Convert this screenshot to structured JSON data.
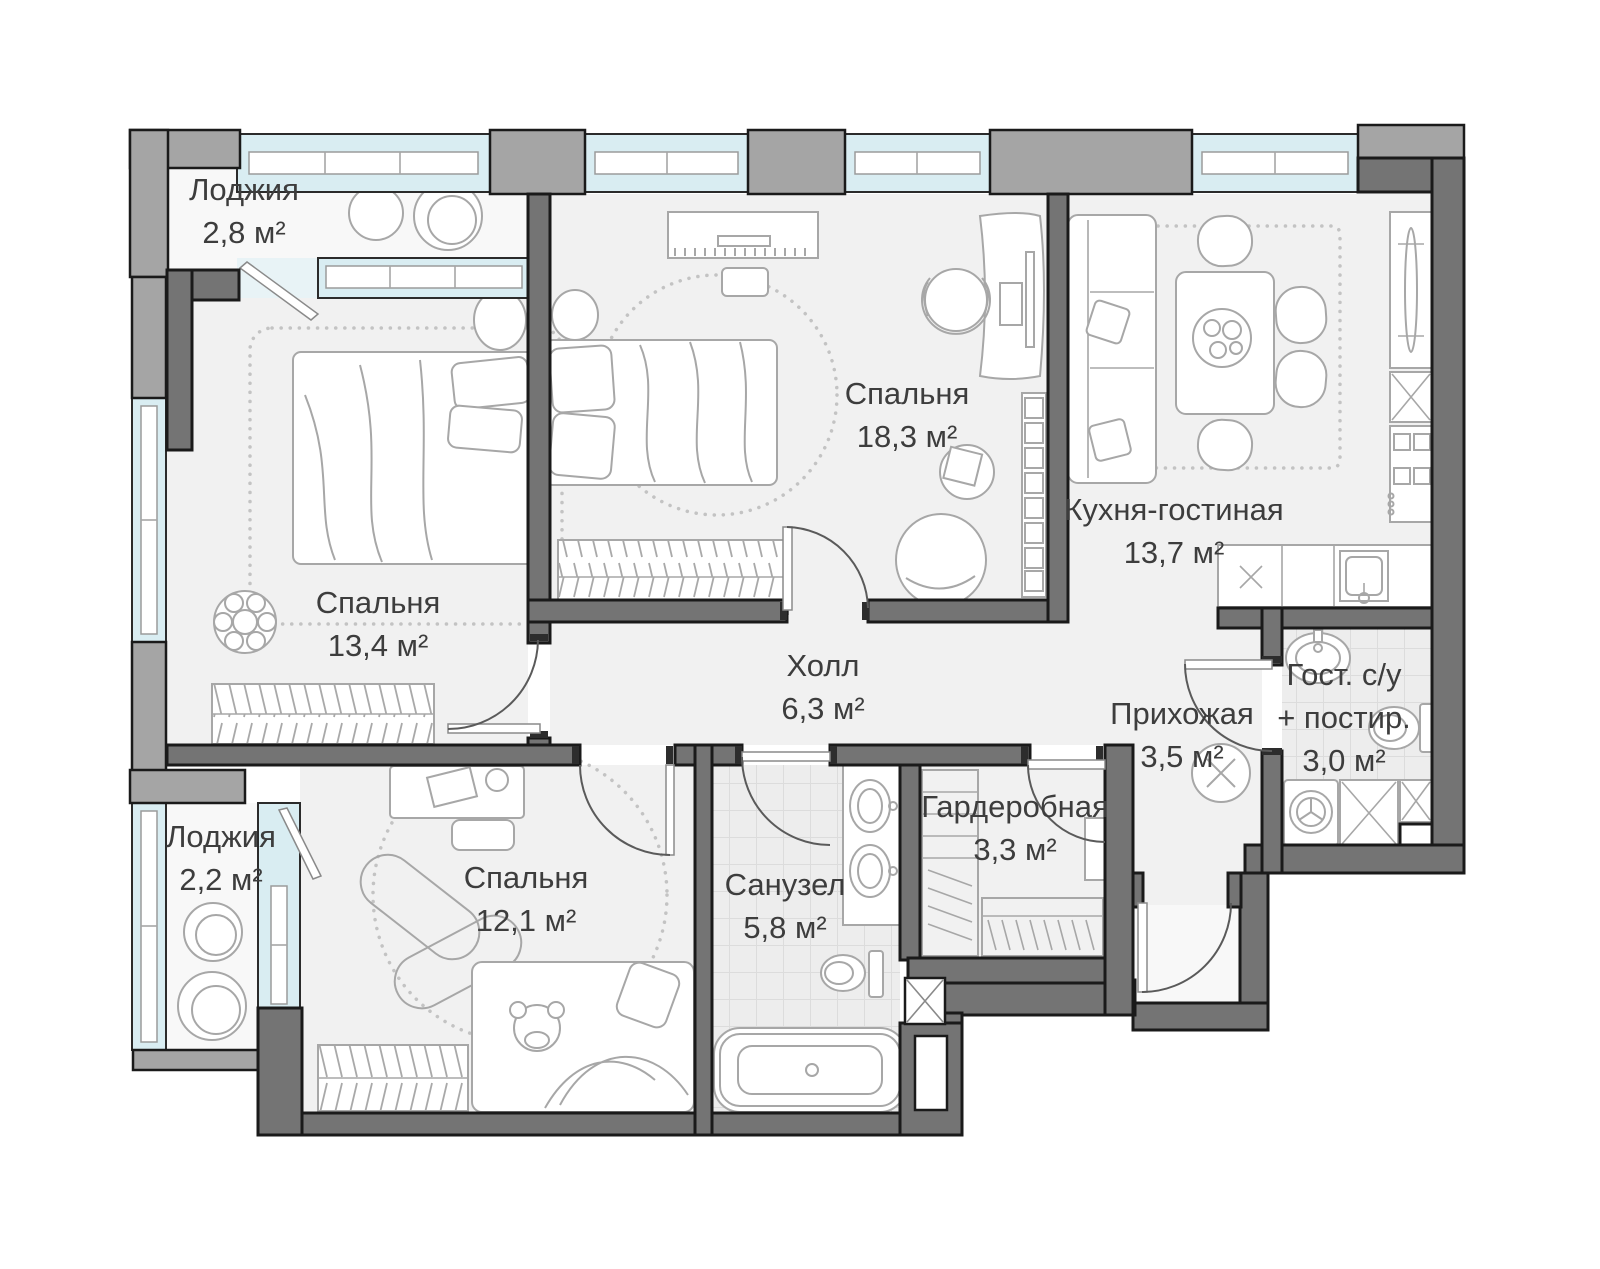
{
  "colors": {
    "wall_dark": "#747474",
    "wall_light": "#a5a5a5",
    "wall_outline": "#1a1a1a",
    "window_glazing": "#d9edf2",
    "floor": "#f1f1f1",
    "loggia_floor": "#f8f8f8",
    "tile_floor": "#ededed",
    "furniture_line": "#a7a7a7",
    "label_text": "#3d3d3d"
  },
  "rooms": [
    {
      "id": "loggia-top",
      "name": "Лоджия",
      "area": "2,8 м²"
    },
    {
      "id": "bedroom-left",
      "name": "Спальня",
      "area": "13,4 м²"
    },
    {
      "id": "bedroom-top",
      "name": "Спальня",
      "area": "18,3 м²"
    },
    {
      "id": "kitchen-living",
      "name": "Кухня-гостиная",
      "area": "13,7 м²"
    },
    {
      "id": "hall",
      "name": "Холл",
      "area": "6,3 м²"
    },
    {
      "id": "entry-hall",
      "name": "Прихожая",
      "area": "3,5 м²"
    },
    {
      "id": "guest-bathroom",
      "name": "Гост. с/у",
      "name_line2": "+ постир.",
      "area": "3,0 м²"
    },
    {
      "id": "loggia-bottom",
      "name": "Лоджия",
      "area": "2,2 м²"
    },
    {
      "id": "bedroom-bottom",
      "name": "Спальня",
      "area": "12,1 м²"
    },
    {
      "id": "bathroom",
      "name": "Санузел",
      "area": "5,8 м²"
    },
    {
      "id": "wardrobe-room",
      "name": "Гардеробная",
      "area": "3,3 м²"
    }
  ]
}
